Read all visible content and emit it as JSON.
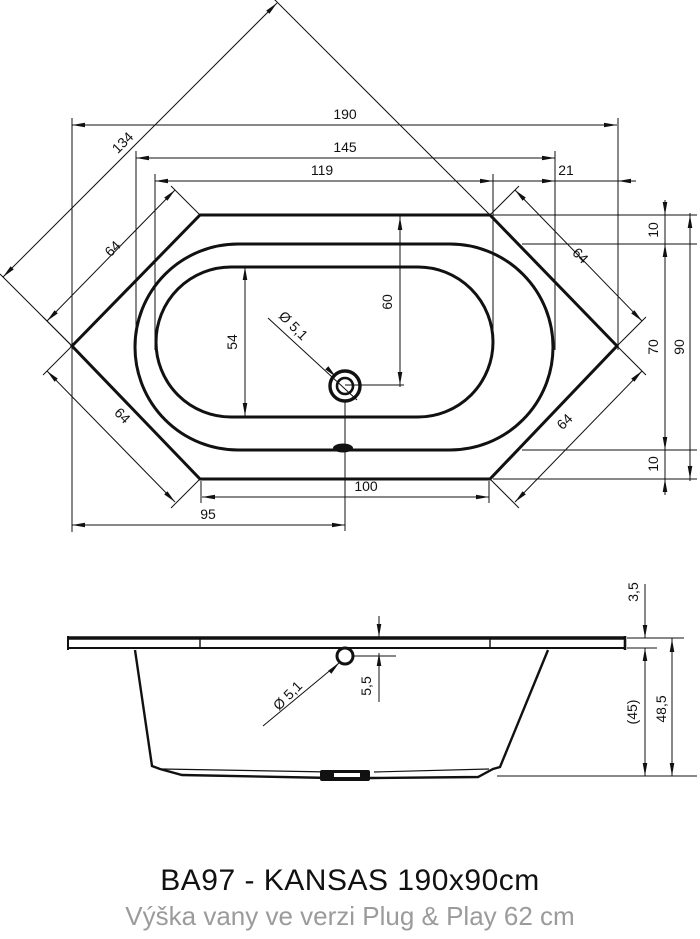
{
  "title": "BA97 - KANSAS 190x90cm",
  "subtitle": "Výška vany ve verzi Plug & Play 62 cm",
  "colors": {
    "line": "#111111",
    "subtitle_gray": "#9b9b9b"
  },
  "dims": {
    "overall_length": "190",
    "rim_inner_length": "145",
    "basin_length": "119",
    "end_gap": "21",
    "diagonal_width": "134",
    "corner_edge_tl": "64",
    "corner_edge_tr": "64",
    "corner_edge_bl": "64",
    "corner_edge_br": "64",
    "rim_offset_top": "10",
    "rim_offset_bottom": "10",
    "inner_width": "70",
    "overall_width": "90",
    "drain_from_top_edge": "60",
    "basin_width": "54",
    "drain_diameter_top": "Ø 5,1",
    "drain_diameter_side": "Ø 5,1",
    "bottom_edge_length": "100",
    "drain_from_left_vertex": "95",
    "rim_thickness": "3,5",
    "drain_center_depth": "5,5",
    "body_height_ref": "(45)",
    "total_height": "48,5"
  }
}
